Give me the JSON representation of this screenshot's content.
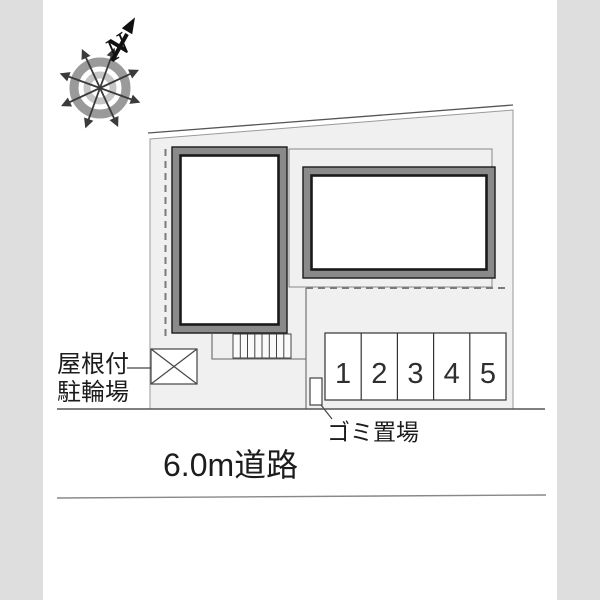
{
  "colors": {
    "page_bg": "#dedede",
    "canvas_bg": "#ffffff",
    "site_fill": "#f0f0f0",
    "wall_gray": "#8a8a8a",
    "line_dark": "#1a1a1a"
  },
  "compass": {
    "north_label": "N"
  },
  "plan": {
    "parking": {
      "spaces": [
        "1",
        "2",
        "3",
        "4",
        "5"
      ]
    },
    "labels": {
      "bicycle_parking_line1": "屋根付",
      "bicycle_parking_line2": "駐輪場",
      "garbage": "ゴミ置場",
      "road": "6.0m道路"
    }
  }
}
